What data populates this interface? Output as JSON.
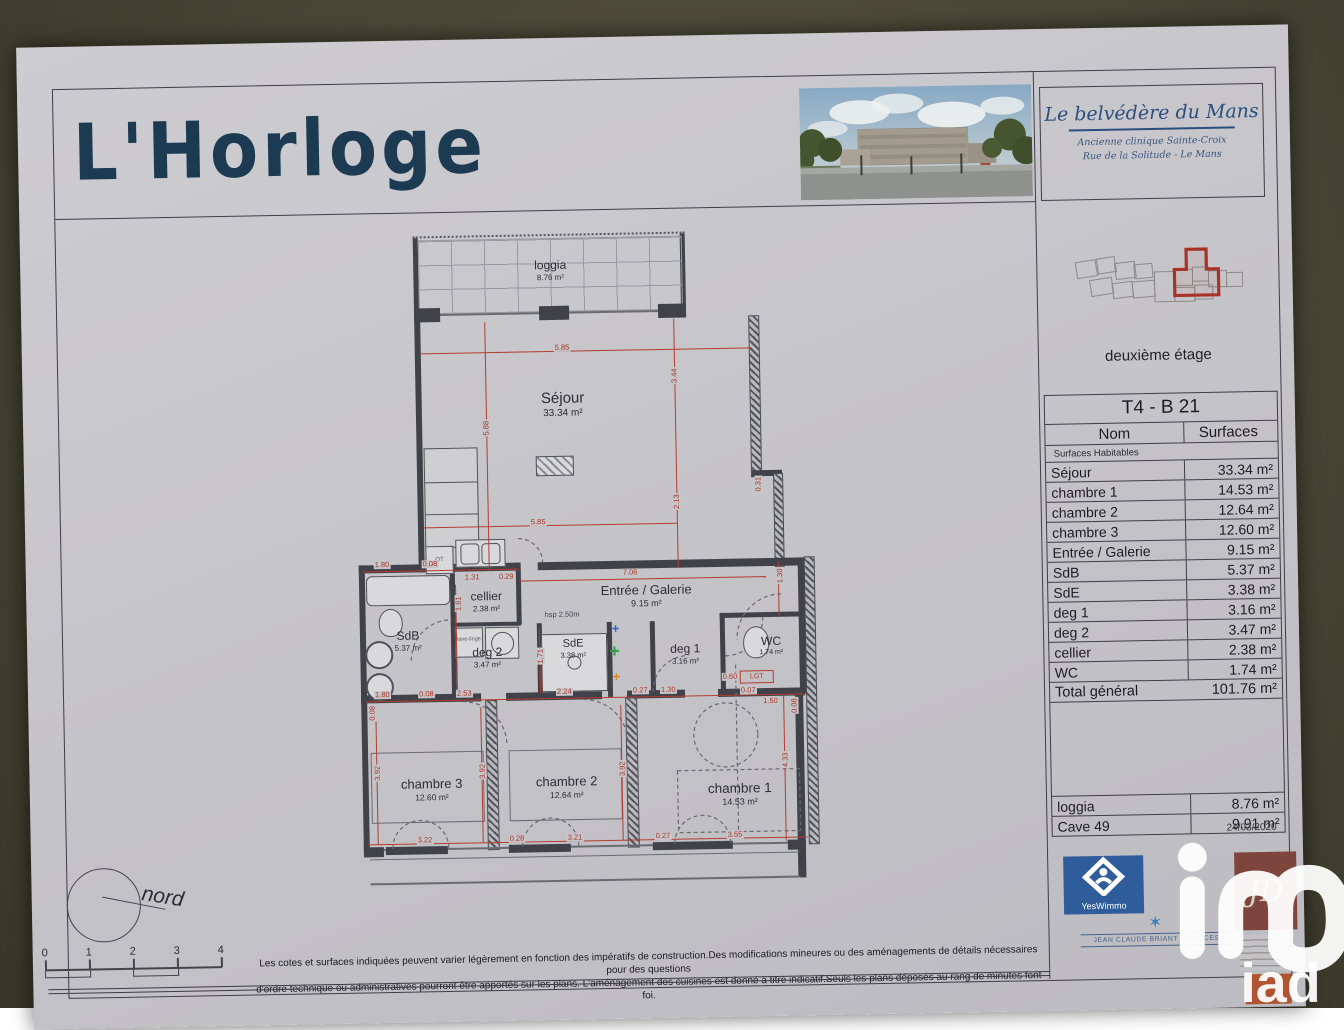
{
  "header": {
    "title": "L'Horloge",
    "project": "Le belvédère du Mans",
    "project_sub1": "Ancienne clinique Sainte-Croix",
    "project_sub2": "Rue de la Solitude - Le Mans"
  },
  "floor": {
    "label": "deuxième étage"
  },
  "unit_table": {
    "unit": "T4 - B 21",
    "col_name": "Nom",
    "col_surface": "Surfaces",
    "section": "Surfaces Habitables",
    "rows": [
      {
        "name": "Séjour",
        "surface": "33.34 m²"
      },
      {
        "name": "chambre 1",
        "surface": "14.53 m²"
      },
      {
        "name": "chambre 2",
        "surface": "12.64 m²"
      },
      {
        "name": "chambre 3",
        "surface": "12.60 m²"
      },
      {
        "name": "Entrée / Galerie",
        "surface": "9.15 m²"
      },
      {
        "name": "SdB",
        "surface": "5.37 m²"
      },
      {
        "name": "SdE",
        "surface": "3.38 m²"
      },
      {
        "name": "deg 1",
        "surface": "3.16 m²"
      },
      {
        "name": "deg 2",
        "surface": "3.47 m²"
      },
      {
        "name": "cellier",
        "surface": "2.38 m²"
      },
      {
        "name": "WC",
        "surface": "1.74 m²"
      }
    ],
    "total_label": "Total général",
    "total_value": "101.76 m²",
    "annex_rows": [
      {
        "name": "loggia",
        "surface": "8.76 m²"
      },
      {
        "name": "Cave 49",
        "surface": "9.91 m²"
      }
    ],
    "date": "24/03/2020"
  },
  "plan": {
    "rooms": {
      "loggia": {
        "name": "loggia",
        "area": "8.76 m²"
      },
      "sejour": {
        "name": "Séjour",
        "area": "33.34 m²"
      },
      "cellier": {
        "name": "cellier",
        "area": "2.38 m²"
      },
      "entree": {
        "name": "Entrée / Galerie",
        "area": "9.15 m²"
      },
      "sdb": {
        "name": "SdB",
        "area": "5.37 m²"
      },
      "sde": {
        "name": "SdE",
        "area": "3.38 m²"
      },
      "deg1": {
        "name": "deg 1",
        "area": "3.16 m²"
      },
      "deg2": {
        "name": "deg 2",
        "area": "3.47 m²"
      },
      "wc": {
        "name": "WC",
        "area": "1.74 m²"
      },
      "ch1": {
        "name": "chambre 1",
        "area": "14.53 m²"
      },
      "ch2": {
        "name": "chambre 2",
        "area": "12.64 m²"
      },
      "ch3": {
        "name": "chambre 3",
        "area": "12.60 m²"
      }
    },
    "annotations": {
      "hsp": "hsp 2.50m",
      "lgt": "LGT",
      "lave": "lave-linge",
      "qt": "QT"
    },
    "dims": [
      "5.85",
      "3.44",
      "5.88",
      "5.85",
      "2.13",
      "0.31",
      "1.80",
      "0.08",
      "1.31",
      "0.29",
      "7.06",
      "1.61",
      "1.30",
      "1.71",
      "1.80",
      "0.08",
      "2.53",
      "2.24",
      "0.27",
      "1.30",
      "0.60",
      "0.07",
      "1.50",
      "3.92",
      "3.92",
      "3.92",
      "4.33",
      "3.22",
      "0.28",
      "3.21",
      "0.27",
      "3.55",
      "0.08",
      "0.08"
    ]
  },
  "compass": {
    "label": "nord"
  },
  "scalebar": {
    "ticks": [
      "0",
      "1",
      "2",
      "3",
      "4"
    ]
  },
  "disclaimer": {
    "line1": "Les cotes et surfaces indiquées peuvent varier légèrement en fonction des impératifs de construction.Des modifications mineures ou des aménagements de détails nécessaires pour des questions",
    "line2": "d'ordre technique ou administratives pourront être apportés sur les plans. L'aménagement des cuisines est donné à titre indicatif.Seuls les plans déposés au rang de minutes font foi."
  },
  "logos": {
    "yeswimmo": "YesWimmo",
    "jd": "JD",
    "briant": "JEAN CLAUDE BRIANT FINANCES",
    "iad": "iad"
  },
  "colors": {
    "accent_red": "#b43c2f",
    "navy": "#1c3a52",
    "paper": "#c6c5c9",
    "background": "#474534"
  }
}
